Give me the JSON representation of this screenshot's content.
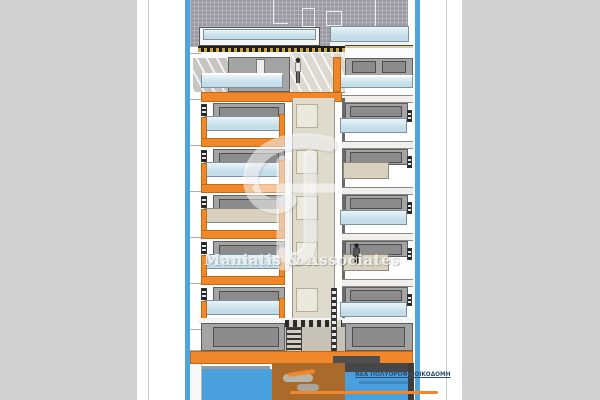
{
  "watermark": {
    "text": "Maniatis & Associates",
    "logo": "maniatis-monogram-logo"
  },
  "caption": {
    "line1": "ΝΕΑ ΠΟΛΥΟΡΟΦΗ ΟΙΚΟΔΟΜΗ"
  },
  "drawing": {
    "type": "architectural-cross-section",
    "floors": {
      "left_panels": [
        "glass",
        "glass",
        "tan",
        "glass",
        "glass"
      ],
      "right_panels": [
        "glass",
        "tan",
        "glass",
        "tan",
        "glass"
      ]
    },
    "level_lines_y": [
      53,
      99,
      145,
      191,
      237,
      283,
      329,
      350
    ],
    "figures": [
      "person-upper-balcony",
      "person-lower-floor"
    ]
  },
  "colors": {
    "app_bg": "#d1d1d1",
    "page": "#ffffff",
    "page_rule": "#c9c9c9",
    "frame_blue": "#4fa5da",
    "orange": "#f0882b",
    "orange_dark": "#c06a15",
    "glass_light": "#e9f3f7",
    "glass_blue": "#c3dde9",
    "wall_gray": "#a4a4a4",
    "window_gray": "#8c8c8c",
    "outline_gray": "#5e5e5e",
    "hatch_base": "#9a99a1",
    "hatch_line": "#b3b2bb",
    "core_beige": "#dedacc",
    "door_beige": "#ebe8dc",
    "tan_panel": "#d8d1c0",
    "slab_black": "#1d1d1d",
    "insul_yellow": "#caa43e",
    "pool_blue": "#4aa0dc",
    "earth_brown": "#a96a2c",
    "dark_band": "#474747",
    "white_band": "#f0efec",
    "caption_navy": "#2e4f74",
    "watermark_white": "rgba(250,250,250,0.8)"
  }
}
